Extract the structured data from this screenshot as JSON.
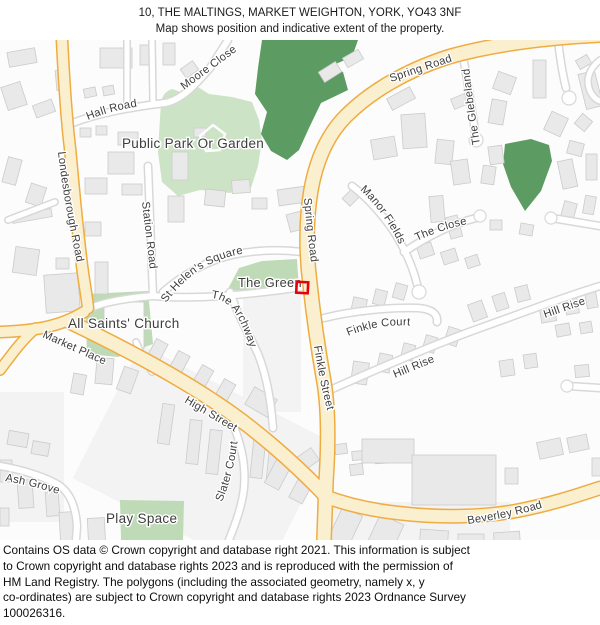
{
  "header": {
    "line1": "10, THE MALTINGS, MARKET WEIGHTON, YORK, YO43 3NF",
    "line2": "Map shows position and indicative extent of the property."
  },
  "footer": {
    "line1": "Contains OS data © Crown copyright and database right 2021. This information is subject",
    "line2": "to Crown copyright and database rights 2023 and is reproduced with the permission of",
    "line3": "HM Land Registry. The polygons (including the associated geometry, namely x, y",
    "line4": "co-ordinates) are subject to Crown copyright and database rights 2023 Ordnance Survey",
    "line5": "100026316."
  },
  "map": {
    "colors": {
      "background": "#FCFCFC",
      "road_major_fill": "#FAF0CF",
      "road_major_casing": "#EFAC41",
      "road_minor_fill": "#FFFFFF",
      "road_minor_casing": "#D8D8D8",
      "building_fill": "#E9E9E9",
      "building_stroke": "#CBCBCB",
      "parcel_fill": "#F3F3F3",
      "green_light": "#CCE3C5",
      "green_mid": "#BFDAB6",
      "green_dark": "#5C9C62",
      "label_text": "#3D3D3D",
      "marker_red": "#E8000D"
    },
    "labels": {
      "moore_close": "Moore Close",
      "hall_road": "Hall Road",
      "public_park": "Public Park Or Garden",
      "londesborough_road": "Londesborough Road",
      "station_road": "Station Road",
      "spring_road_upper": "Spring Road",
      "spring_road_lower": "Spring Road",
      "the_glebelands": "The Glebelands",
      "manor_fields": "Manor Fields",
      "the_close": "The Close",
      "st_helens_square": "St Helen's Square",
      "the_green": "The Green",
      "the_archway": "The Archway",
      "all_saints_church": "All Saints' Church",
      "finkle_court": "Finkle Court",
      "hill_rise_lower": "Hill Rise",
      "hill_rise_upper": "Hill Rise",
      "market_place": "Market Place",
      "high_street": "High Street",
      "finkle_street": "Finkle Street",
      "ash_grove": "Ash Grove",
      "slater_court": "Slater Court",
      "play_space": "Play Space",
      "beverley_road": "Beverley Road"
    }
  }
}
